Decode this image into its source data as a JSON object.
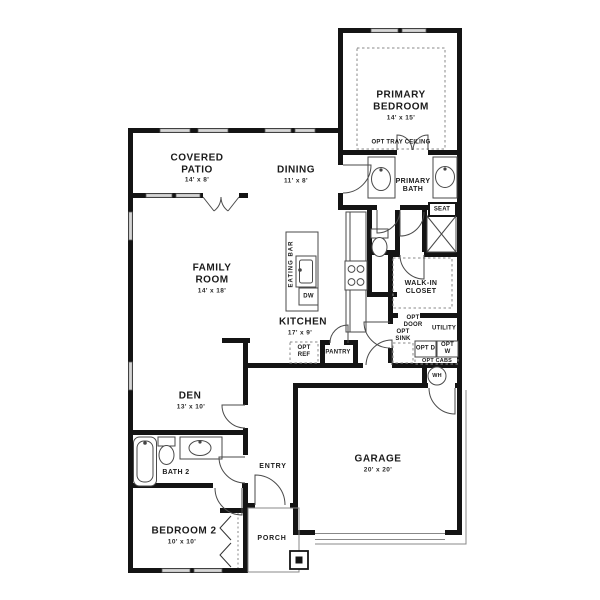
{
  "plan": {
    "rooms": {
      "primary_bedroom": {
        "name": "PRIMARY BEDROOM",
        "dims": "14' x 15'",
        "note": "OPT TRAY CEILING"
      },
      "primary_bath": {
        "name": "PRIMARY BATH"
      },
      "walk_in_closet": {
        "name": "WALK-IN CLOSET"
      },
      "utility": {
        "name": "UTILITY"
      },
      "covered_patio": {
        "name": "COVERED PATIO",
        "dims": "14' x 8'"
      },
      "dining": {
        "name": "DINING",
        "dims": "11' x 8'"
      },
      "family_room": {
        "name": "FAMILY ROOM",
        "dims": "14' x 18'"
      },
      "kitchen": {
        "name": "KITCHEN",
        "dims": "17' x 9'"
      },
      "den": {
        "name": "DEN",
        "dims": "13' x 10'"
      },
      "bath2": {
        "name": "BATH 2"
      },
      "bedroom2": {
        "name": "BEDROOM 2",
        "dims": "10' x 10'"
      },
      "entry": {
        "name": "ENTRY"
      },
      "porch": {
        "name": "PORCH"
      },
      "garage": {
        "name": "GARAGE",
        "dims": "20' x 20'"
      }
    },
    "features": {
      "seat": "SEAT",
      "eating_bar": "EATING BAR",
      "dw": "DW",
      "opt_ref": "OPT REF",
      "pantry": "PANTRY",
      "opt_door": "OPT DOOR",
      "opt_sink": "OPT SINK",
      "opt_d": "OPT D",
      "opt_w": "OPT W",
      "opt_cabs": "OPT CABS",
      "wh": "WH"
    },
    "colors": {
      "wall": "#141414",
      "line": "#4a4a4a",
      "window": "#d6d6d6"
    }
  }
}
